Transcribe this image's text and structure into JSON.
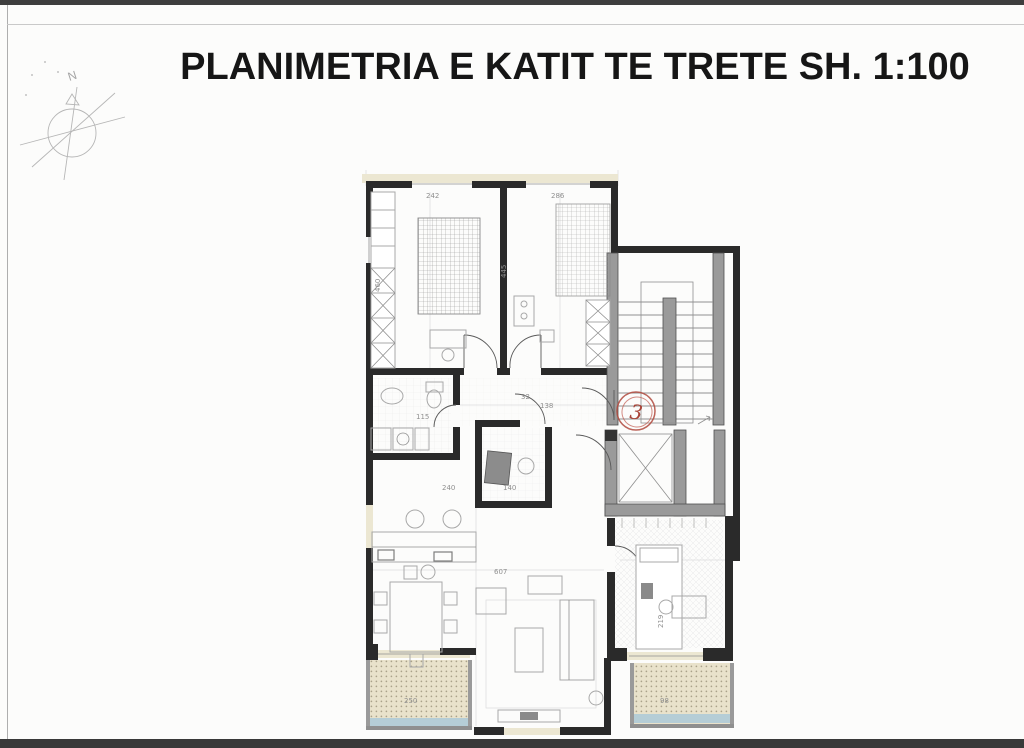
{
  "header": {
    "title": "PLANIMETRIA E KATIT TE TRETE SH. 1:100"
  },
  "compass": {
    "label": "N"
  },
  "plan": {
    "floor_marker": "3"
  },
  "dims": [
    "242",
    "286",
    "460",
    "445",
    "32",
    "138",
    "115",
    "240",
    "140",
    "607",
    "219",
    "250",
    "98"
  ],
  "colors": {
    "wall": "#2a2a2a",
    "gray_wall": "#9a9a9a",
    "window_band": "#ece7d2",
    "balcony_fill": "#e9e2cb",
    "balcony_edge_strip": "#b5cdd6",
    "marker_red": "#b0493d",
    "furniture_line": "#a8a8a8",
    "page_top_band": "#3e3e3e"
  }
}
